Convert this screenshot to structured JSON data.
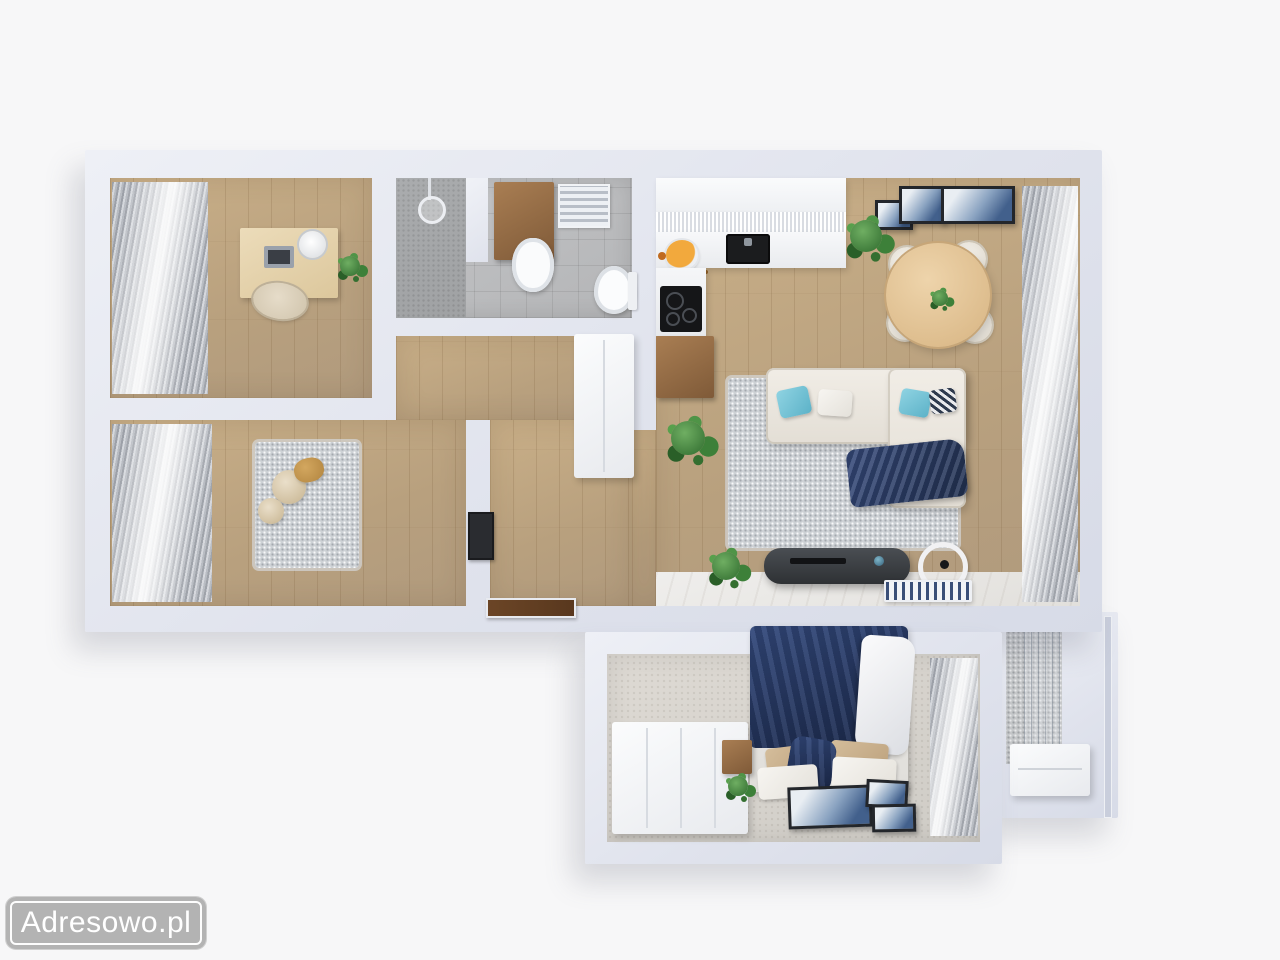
{
  "watermark": {
    "label": "Adresowo.pl",
    "bg": "#b0b0b0",
    "text_color": "#ffffff"
  },
  "palette": {
    "background": "#f7f7f8",
    "wall": "#e2e5ee",
    "wood_floor": "#bda587",
    "bathroom_tile": "#bcbdbf",
    "bedroom_floor": "#d7d3cd",
    "rug_gray": "#cdd1d5",
    "sofa_cream": "#ece8e0",
    "accent_navy": "#27365c",
    "accent_teal": "#6fc3d8",
    "table_wood": "#e3c49b",
    "cabinet_wood": "#946a44",
    "plant_green": "#3d7d38",
    "stone_balcony": "#c6c8ca"
  },
  "scene": {
    "type": "3d-apartment-floor-plan-top-view",
    "rooms": [
      {
        "name": "office-dining-room",
        "position": "top-left",
        "furniture": [
          "desk",
          "laptop",
          "desk-lamp",
          "chair",
          "plant",
          "window-curtains"
        ]
      },
      {
        "name": "kids-room",
        "position": "bottom-left",
        "furniture": [
          "gray-rug",
          "plush-toys",
          "wall-tv",
          "window-curtains"
        ]
      },
      {
        "name": "bathroom",
        "position": "top-middle",
        "furniture": [
          "shower",
          "wood-vanity-with-sink",
          "towel-radiator",
          "toilet"
        ]
      },
      {
        "name": "hallway",
        "position": "middle",
        "furniture": [
          "tall-wardrobe",
          "entrance-door",
          "plant"
        ]
      },
      {
        "name": "kitchen-living-room",
        "position": "right",
        "furniture": [
          "upper-cabinets",
          "white-counter",
          "black-sink",
          "fruit-bowl",
          "cooktop",
          "wood-cabinet",
          "round-dining-table",
          "four-chairs",
          "wall-art-frames",
          "plants",
          "corner-sofa",
          "teal-pillows",
          "navy-blanket",
          "gray-rug",
          "tv-console",
          "hoop-decor",
          "radiator",
          "window-curtains"
        ]
      },
      {
        "name": "bedroom",
        "position": "bottom",
        "furniture": [
          "double-bed-navy-bedding",
          "pillows",
          "white-wardrobe",
          "bedside-table",
          "plant",
          "floor-art-frames",
          "window-curtains"
        ]
      },
      {
        "name": "balcony",
        "position": "bottom-right",
        "furniture": [
          "storage-box",
          "glass-railing",
          "stone-tiles"
        ]
      }
    ]
  }
}
